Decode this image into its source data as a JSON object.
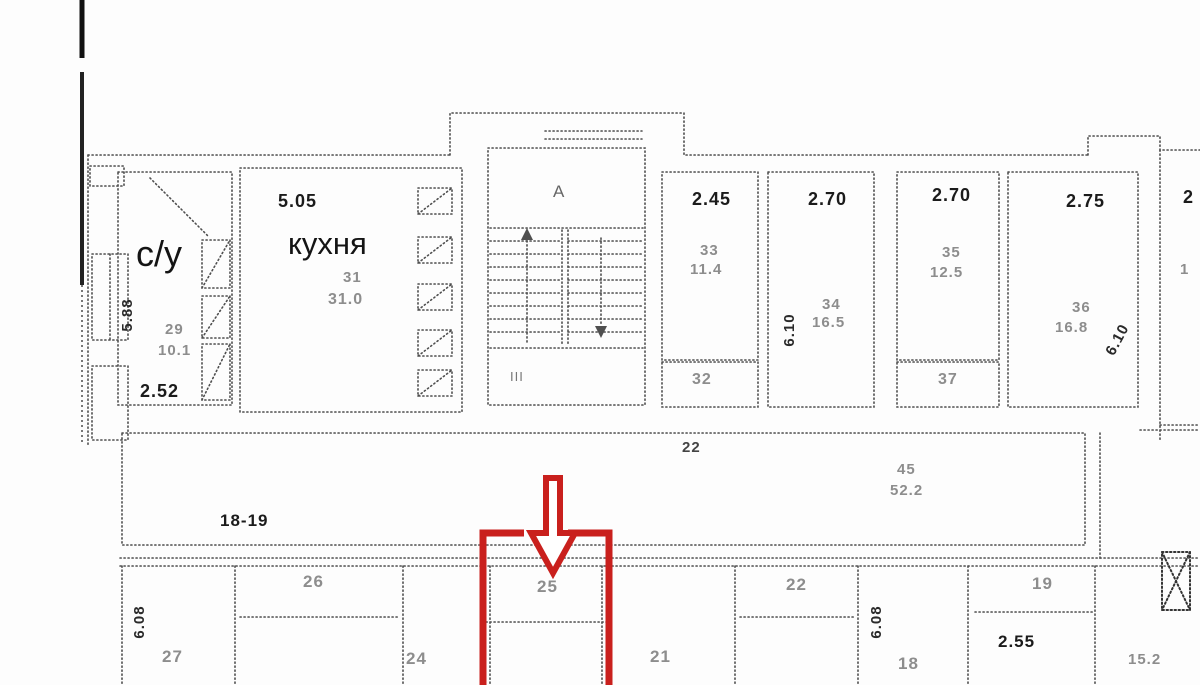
{
  "colors": {
    "highlight": "#c9201d",
    "wall": "#4f4f4f",
    "faint_text": "#8d8d8d",
    "dark_text": "#1b1b1b"
  },
  "top_rooms": {
    "bathroom": {
      "label": "с/у",
      "bottom_dim": "2.52",
      "side_dim": "5.88",
      "number": "29",
      "area": "10.1"
    },
    "kitchen": {
      "label": "кухня",
      "top_dim": "5.05",
      "number": "31",
      "area": "31.0"
    },
    "stair": {
      "letter": "А",
      "mark": "III"
    },
    "r33": {
      "top_dim": "2.45",
      "number": "33",
      "area": "11.4"
    },
    "r32": {
      "number": "32"
    },
    "r34": {
      "top_dim": "2.70",
      "side_dim": "6.10",
      "number": "34",
      "area": "16.5"
    },
    "r35": {
      "top_dim": "2.70",
      "number": "35",
      "area": "12.5"
    },
    "r37": {
      "number": "37"
    },
    "r36": {
      "top_dim": "2.75",
      "side_dim": "6.10",
      "number": "36",
      "area": "16.8"
    },
    "edge": {
      "top_dim": "2",
      "number": "1"
    }
  },
  "corridor": {
    "number": "22",
    "hall_number": "45",
    "hall_area": "52.2",
    "range_label": "18-19"
  },
  "bottom_rooms": {
    "r27": {
      "side_dim": "6.08",
      "number": "27"
    },
    "r26": {
      "number": "26"
    },
    "r24": {
      "number": "24"
    },
    "r25": {
      "number": "25"
    },
    "r21": {
      "number": "21"
    },
    "r22": {
      "number": "22"
    },
    "r18": {
      "side_dim": "6.08",
      "number": "18"
    },
    "r19": {
      "number": "19",
      "dim": "2.55"
    },
    "edge": {
      "area": "15.2"
    }
  },
  "annotation": {
    "highlighted_room_number": "25"
  }
}
